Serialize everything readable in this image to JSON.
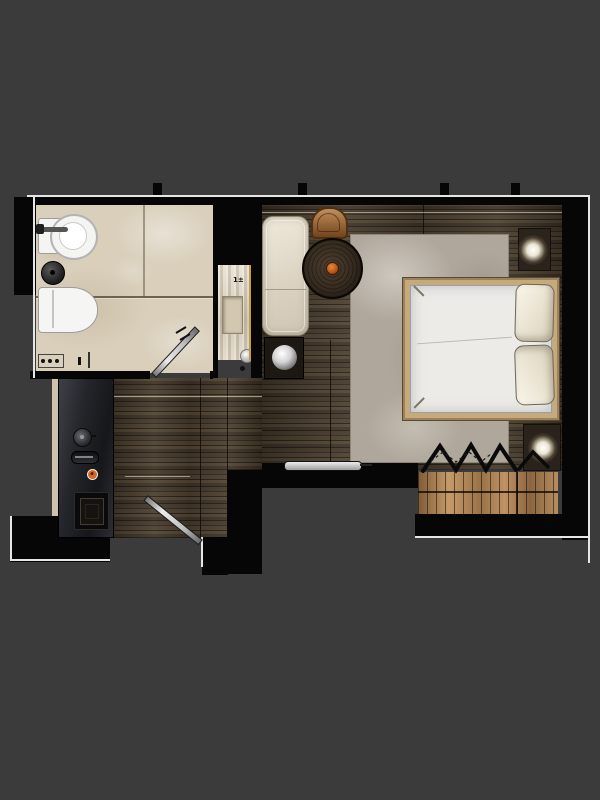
{
  "meta": {
    "title": "Hotel room floor plan (top-down rendering)"
  },
  "palette": {
    "background": "#3b3b3b",
    "wall": "#060606",
    "outline": "#e6e6e6",
    "bathroom_tile": "#d9cfbb",
    "wood_floor": "#42372a",
    "rug": "#afa79c",
    "bed_frame": "#c6aa7c",
    "bedding_white": "#ecebe7",
    "pillow_cream": "#f4efe0",
    "wardrobe_wood": "#b08757",
    "copper_chair": "#b5835a",
    "accent_orange": "#c8511a",
    "console_dark": "#26272c",
    "niche_wood": "#d8cfbe",
    "gold_trim": "#c79a3e",
    "lamp_glow": "#ffffff"
  },
  "annotations": {
    "niche_mark": "1±"
  },
  "rooms": [
    {
      "name": "bathroom",
      "features": [
        "sink-with-faucet",
        "round-basin",
        "wall-hung-toilet",
        "shower-area",
        "shower-controls",
        "bathroom-door-swing",
        "tile-floor"
      ]
    },
    {
      "name": "bedroom",
      "features": [
        "double-bed",
        "two-pillows",
        "area-rug",
        "nightstand-lamp-top",
        "nightstand-lamp-bottom",
        "chaise-longue",
        "round-side-table",
        "copper-chair",
        "ball-lamp-side-table",
        "wardrobe-with-hangers",
        "wall-mounted-tv",
        "wood-plank-floor"
      ]
    },
    {
      "name": "entry-corridor",
      "features": [
        "minibar-console",
        "console-knob",
        "console-tray",
        "orange-button",
        "built-in-appliance",
        "entry-door-swing",
        "wall-niche-shelf"
      ]
    }
  ]
}
